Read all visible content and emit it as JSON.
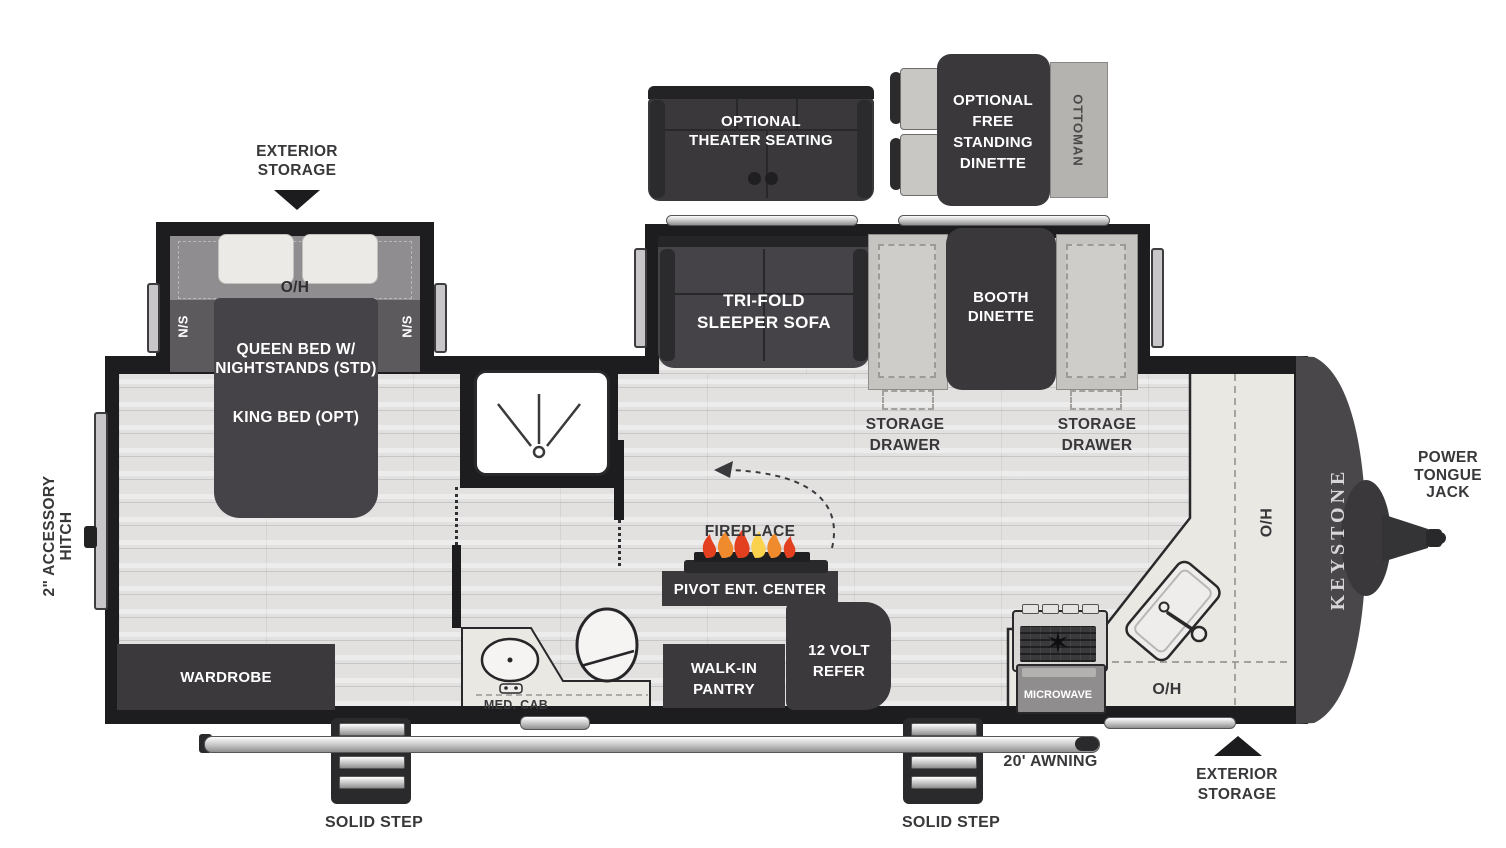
{
  "colors": {
    "wall": "#1d1c1e",
    "furniture_dark": "#3b393c",
    "floor": "#e2e1e0",
    "counter": "#eae8e2",
    "label_text": "#38373a",
    "flame_red": "#e2401f",
    "flame_orange": "#f08b2d",
    "flame_yellow": "#fbd24d"
  },
  "exterior": {
    "storage_rear": {
      "line1": "EXTERIOR",
      "line2": "STORAGE"
    },
    "storage_front": {
      "line1": "EXTERIOR",
      "line2": "STORAGE"
    },
    "awning_label": "20' AWNING",
    "step_left_label": "SOLID STEP",
    "step_right_label": "SOLID STEP",
    "tongue_jack": {
      "line1": "POWER",
      "line2": "TONGUE",
      "line3": "JACK"
    },
    "hitch": {
      "line1": "2\" ACCESSORY",
      "line2": "HITCH"
    },
    "brand": "KEYSTONE"
  },
  "optional": {
    "theater": {
      "line1": "OPTIONAL",
      "line2": "THEATER SEATING"
    },
    "dinette": {
      "line1": "OPTIONAL",
      "line2": "FREE",
      "line3": "STANDING",
      "line4": "DINETTE"
    },
    "ottoman": "OTTOMAN"
  },
  "bedroom": {
    "overhead": "O/H",
    "ns_left": "N/S",
    "ns_right": "N/S",
    "bed_line1": "QUEEN BED W/",
    "bed_line2": "NIGHTSTANDS (STD)",
    "bed_line3": "KING BED (OPT)",
    "wardrobe": "WARDROBE"
  },
  "bath": {
    "med_cab": "MED. CAB"
  },
  "living": {
    "sofa": {
      "line1": "TRI-FOLD",
      "line2": "SLEEPER SOFA"
    },
    "booth": {
      "line1": "BOOTH",
      "line2": "DINETTE"
    },
    "drawer_left": {
      "line1": "STORAGE",
      "line2": "DRAWER"
    },
    "drawer_right": {
      "line1": "STORAGE",
      "line2": "DRAWER"
    },
    "fireplace": "FIREPLACE",
    "ent_center": "PIVOT ENT. CENTER",
    "pantry": {
      "line1": "WALK-IN",
      "line2": "PANTRY"
    },
    "refer": {
      "line1": "12 VOLT",
      "line2": "REFER"
    }
  },
  "kitchen": {
    "microwave": "MICROWAVE",
    "ho": "O/H",
    "oh": "O/H"
  }
}
